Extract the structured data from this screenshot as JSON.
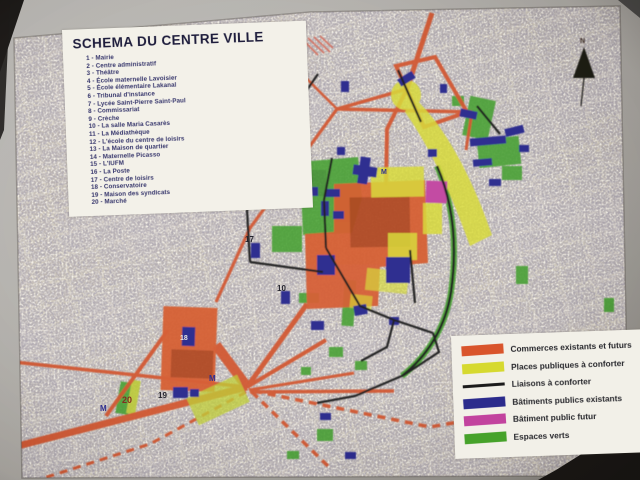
{
  "photo": {
    "title_box": {
      "title": "SCHEMA DU CENTRE VILLE",
      "items": [
        "1 - Mairie",
        "2 - Centre administratif",
        "3 - Théâtre",
        "4 - École maternelle Lavoisier",
        "5 - École élémentaire Lakanal",
        "6 - Tribunal d'instance",
        "7 - Lycée Saint-Pierre Saint-Paul",
        "8 - Commissariat",
        "9 - Crèche",
        "10 - La salle Maria Casarès",
        "11 - La Médiathèque",
        "12 - L'école du centre de loisirs",
        "13 - La Maison de quartier",
        "14 - Maternelle Picasso",
        "15 - L'IUFM",
        "16 - La Poste",
        "17 - Centre de loisirs",
        "18 - Conservatoire",
        "19 - Maison des syndicats",
        "20 - Marché"
      ]
    },
    "legend": {
      "entries": [
        {
          "label": "Commerces existants et futurs",
          "color": "#d9542b",
          "shape": "bar"
        },
        {
          "label": "Places publiques à conforter",
          "color": "#d6d92f",
          "shape": "bar"
        },
        {
          "label": "Liaisons à conforter",
          "color": "#1b1b1b",
          "shape": "line"
        },
        {
          "label": "Bâtiments publics existants",
          "color": "#2b2b8c",
          "shape": "bar"
        },
        {
          "label": "Bâtiment public futur",
          "color": "#c2439e",
          "shape": "bar"
        },
        {
          "label": "Espaces verts",
          "color": "#46a22a",
          "shape": "bar"
        }
      ]
    },
    "north_label": "N",
    "map_labels": [
      {
        "text": "M",
        "x": 381,
        "y": 174,
        "color": "#22228a",
        "size": 7
      },
      {
        "text": "M",
        "x": 209,
        "y": 381,
        "color": "#22228a",
        "size": 8
      },
      {
        "text": "M",
        "x": 100,
        "y": 411,
        "color": "#22228a",
        "size": 8
      },
      {
        "text": "17",
        "x": 245,
        "y": 242,
        "color": "#15151f",
        "size": 8
      },
      {
        "text": "10",
        "x": 277,
        "y": 291,
        "color": "#15151f",
        "size": 8
      },
      {
        "text": "19",
        "x": 158,
        "y": 398,
        "color": "#15151f",
        "size": 8
      },
      {
        "text": "20",
        "x": 122,
        "y": 403,
        "color": "#7c2212",
        "size": 9
      },
      {
        "text": "18",
        "x": 180,
        "y": 340,
        "color": "#e9e7df",
        "size": 7
      }
    ],
    "colors": {
      "commerces_orange": "#d9542b",
      "places_yellow": "#d6d92f",
      "liaisons_black": "#1b1b1b",
      "batiments_blue": "#2b2b8c",
      "batiment_futur_magenta": "#c2439e",
      "espaces_verts_green": "#46a22a"
    }
  }
}
